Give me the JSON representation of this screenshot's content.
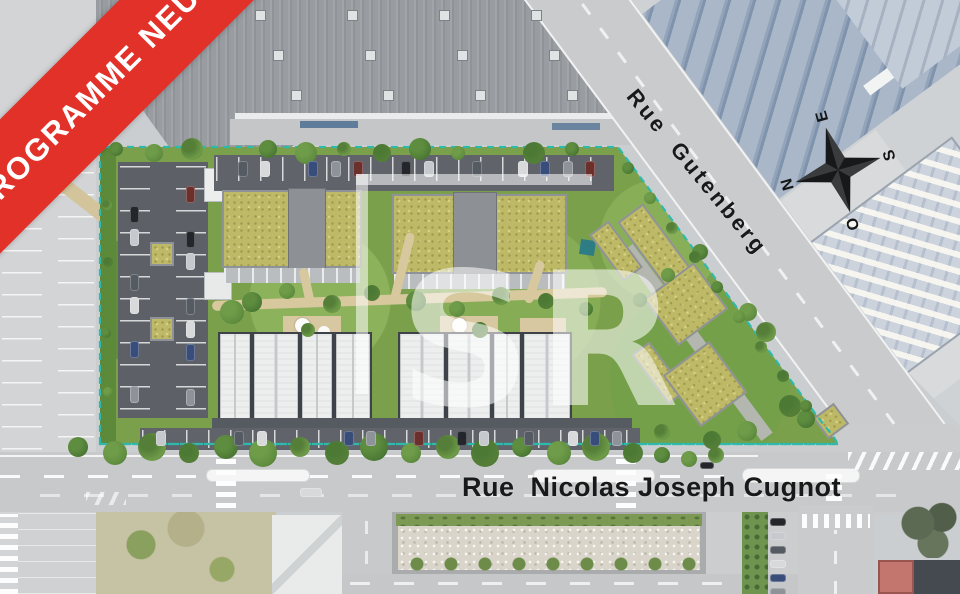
{
  "banner": {
    "label": "PROGRAMME NEUF"
  },
  "streets": {
    "gutenberg": "Rue  Gutenberg",
    "cugnot": "Rue  Nicolas Joseph Cugnot"
  },
  "compass": {
    "north": "N",
    "east": "E",
    "south": "S",
    "west": "O"
  },
  "watermark": {
    "text": "SR"
  },
  "colors": {
    "banner_red": "#e23128",
    "boundary_teal": "#2fb9aa",
    "sedum_roof": "#bdb967",
    "lawn_green": "#7aa04c",
    "asphalt": "#5d6167",
    "road_gray": "#c7c9cb",
    "solar_blue": "#93a4ba",
    "watermark_white": "rgba(255,255,255,0.55)"
  }
}
